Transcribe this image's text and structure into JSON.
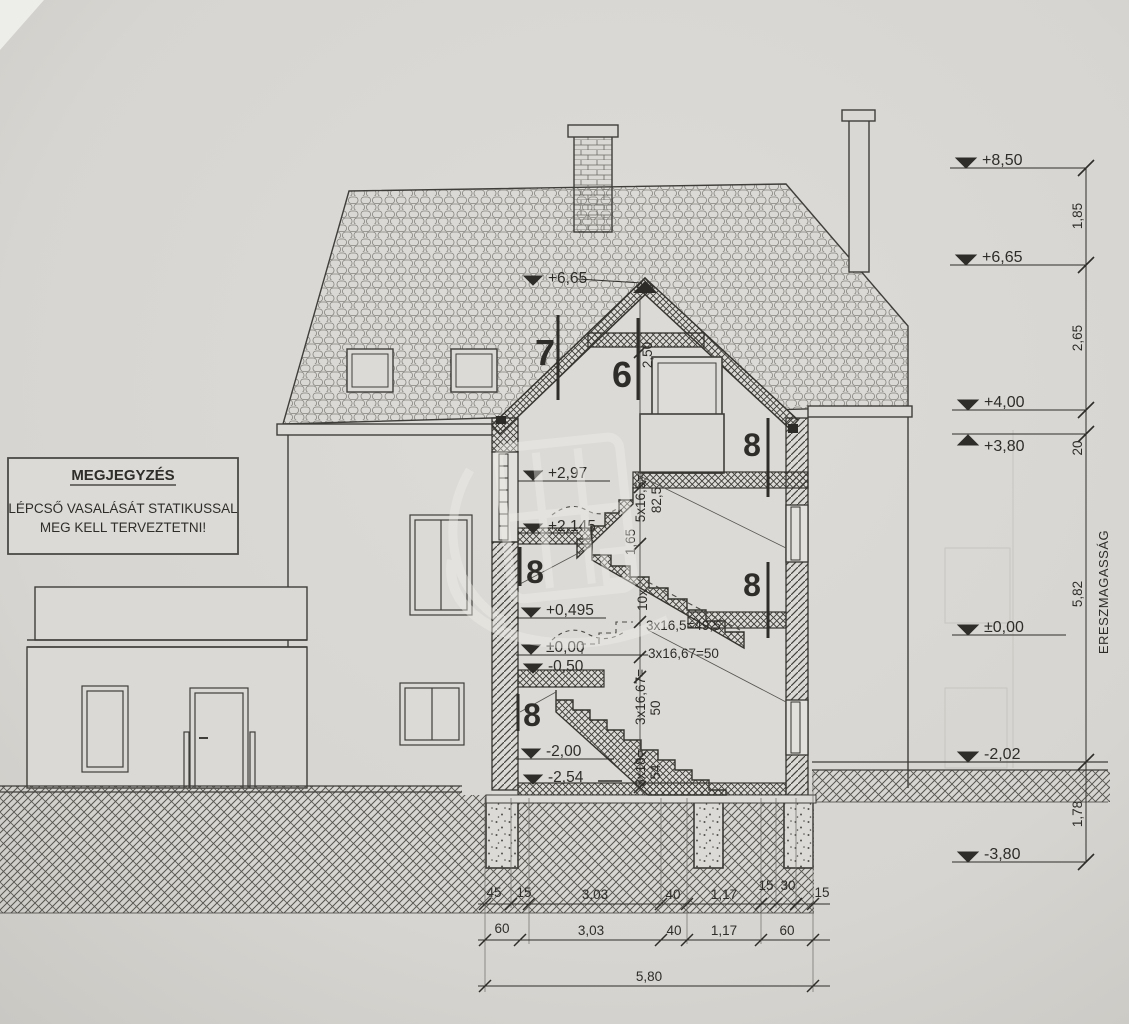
{
  "note": {
    "title": "MEGJEGYZÉS",
    "line1": "LÉPCSŐ VASALÁSÁT STATIKUSSAL",
    "line2": "MEG KELL TERVEZTETNI!"
  },
  "levels": {
    "right": [
      "+8,50",
      "+6,65",
      "+4,00",
      "+3,80",
      "±0,00",
      "-2,02",
      "-3,80"
    ],
    "section": [
      "+6,65",
      "+2,97",
      "+2,145",
      "+0,495",
      "±0,00",
      "-0,50",
      "-2,00",
      "-2,54"
    ]
  },
  "dims": {
    "right": [
      "1,85",
      "2,65",
      "20",
      "5,82",
      "1,78"
    ],
    "eaves_label": "ERESZMAGASSÁG",
    "bottom_row1": [
      "45",
      "15",
      "3,03",
      "40",
      "1,17",
      "15",
      "30",
      "15"
    ],
    "bottom_row2": [
      "60",
      "3,03",
      "40",
      "1,17",
      "60"
    ],
    "bottom_total": "5,80",
    "attic_height": "2,50"
  },
  "rooms": [
    "7",
    "6",
    "8",
    "8",
    "8",
    "8"
  ],
  "stairs": {
    "count_up": "10x",
    "run_a": "3x16,5=49,5",
    "run_b": "3x16,67=50",
    "rise_top_1": "5x16,5=",
    "rise_top_2": "82,5",
    "rise_mid": "1,65",
    "rise_low_1": "3x16,67=",
    "rise_low_2": "50",
    "rise_base_1": "3x18=",
    "rise_base_2": "54"
  }
}
